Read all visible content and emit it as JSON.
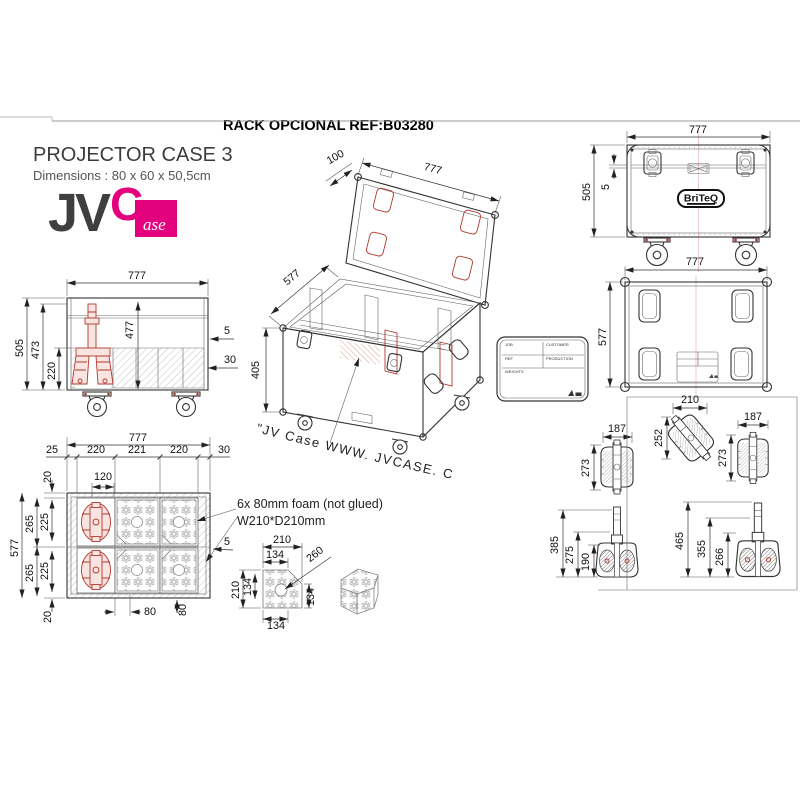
{
  "page": {
    "title": "RACK OPCIONAL REF:B03280",
    "product": {
      "name": "PROJECTOR CASE 3",
      "dimensions": "Dimensions : 80 x 60 x 50,5cm"
    },
    "brand": {
      "jv": "JV",
      "c": "C",
      "ase": "ase"
    },
    "briteq": "BriTeQ",
    "curve_note": "\"JV Case WWW. JVCASE. COM\"LOGO",
    "foam_note_line1": "6x 80mm foam (not glued)",
    "foam_note_line2": "W210*D210mm",
    "label_card": {
      "job": "JOB",
      "customer": "CUSTOMER",
      "ref": "REF",
      "production": "PRODUCTION",
      "weights": "WEIGHTS"
    }
  },
  "dims": {
    "iso": {
      "lid": "100",
      "width": "777",
      "depth": "577",
      "height": "405"
    },
    "front": {
      "width": "777",
      "height": "505",
      "lip": "5"
    },
    "top": {
      "width": "777",
      "depth": "577"
    },
    "section": {
      "width": "777",
      "height": "505",
      "inner": "473",
      "foam": "220",
      "inner2": "477",
      "lip": "5",
      "thick": "30"
    },
    "plan": {
      "width": "777",
      "m_left": "25",
      "c1": "220",
      "c2": "221",
      "c3": "220",
      "m_right": "30",
      "off": "120",
      "m_top": "20",
      "p1": "265",
      "r1": "225",
      "p2": "265",
      "r2": "225",
      "m_bot": "20",
      "depth": "577",
      "gap": "5",
      "fw": "80",
      "fd": "80"
    },
    "detail": {
      "w": "210",
      "wc": "134",
      "d": "210",
      "dc": "134",
      "side": "134",
      "bottom": "134",
      "diag": "260"
    },
    "proj": {
      "w1": "187",
      "h1": "273",
      "t1": "385",
      "b1": "275",
      "l1": "190",
      "w2": "210",
      "h2": "252",
      "w3": "187",
      "h3": "273",
      "t2": "465",
      "b2": "355",
      "l2": "266"
    }
  }
}
